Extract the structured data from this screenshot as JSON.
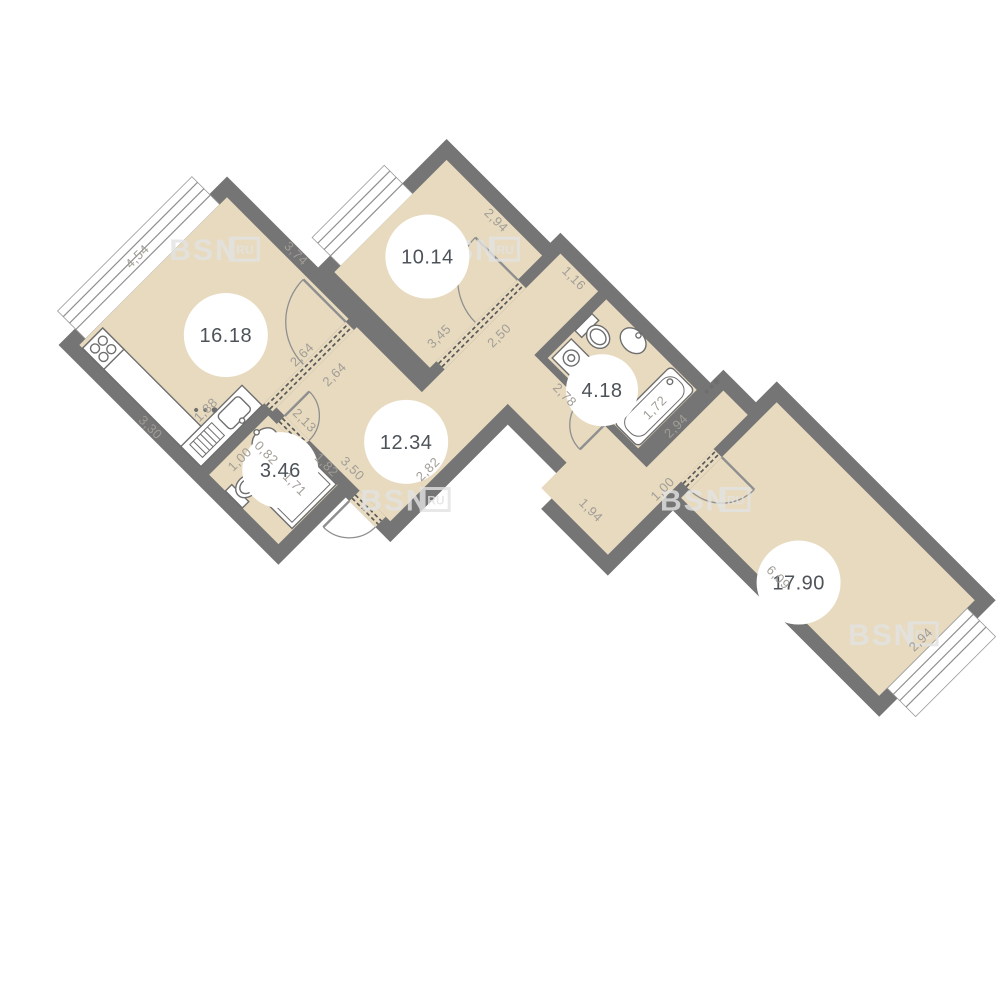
{
  "plan": {
    "type": "apartment-floor-plan",
    "units": "meters",
    "watermark": {
      "brand": "BSN",
      "suffix": "RU"
    }
  },
  "colors": {
    "floor": "#e7dabf",
    "wall": "#757575",
    "dim_text": "#a19d96",
    "area_text": "#4d5359",
    "fixture_stroke": "#6e6e6e",
    "door_arc": "#8f8f8f",
    "background": "#ffffff"
  },
  "rooms": [
    {
      "id": "living-kitchen",
      "area": "16.18"
    },
    {
      "id": "bedroom",
      "area": "10.14"
    },
    {
      "id": "wc",
      "area": "3.46"
    },
    {
      "id": "hallway",
      "area": "12.34"
    },
    {
      "id": "bathroom",
      "area": "4.18"
    },
    {
      "id": "big-room",
      "area": "17.90"
    }
  ],
  "dimensions": [
    {
      "text": "4,54"
    },
    {
      "text": "3,74"
    },
    {
      "text": "3,30"
    },
    {
      "text": "1,88"
    },
    {
      "text": "2,64"
    },
    {
      "text": "2,64"
    },
    {
      "text": "2,50"
    },
    {
      "text": "3,45"
    },
    {
      "text": "2,94"
    },
    {
      "text": "1,16"
    },
    {
      "text": "2,78"
    },
    {
      "text": "1,72"
    },
    {
      "text": "2,94"
    },
    {
      "text": "1,94"
    },
    {
      "text": "1,00"
    },
    {
      "text": "3,50"
    },
    {
      "text": "2,82"
    },
    {
      "text": "2,13"
    },
    {
      "text": "1,82"
    },
    {
      "text": "1,00"
    },
    {
      "text": "0,82"
    },
    {
      "text": "1,71"
    },
    {
      "text": "6,09"
    },
    {
      "text": "2,94"
    }
  ]
}
